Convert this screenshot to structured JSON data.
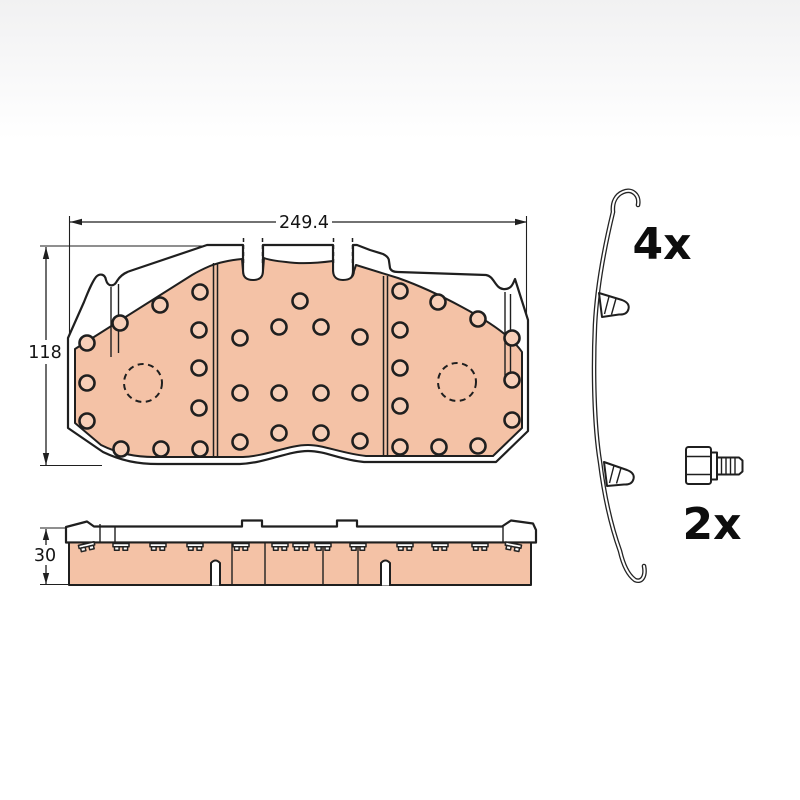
{
  "figure": {
    "type": "technical-diagram",
    "subject": "disc brake pad set with fitting accessories",
    "front_view": {
      "width_label": "249.4",
      "height_label": "118"
    },
    "side_view": {
      "thickness_label": "30"
    },
    "accessories": {
      "spring_clip_qty": "4x",
      "bolt_qty": "2x"
    },
    "colors": {
      "friction_material": "#F4C2A6",
      "hole_fill": "#F7CFB8",
      "outline": "#1F1F1F",
      "background_top": "#F1F1F2",
      "background": "#FFFFFF"
    }
  }
}
